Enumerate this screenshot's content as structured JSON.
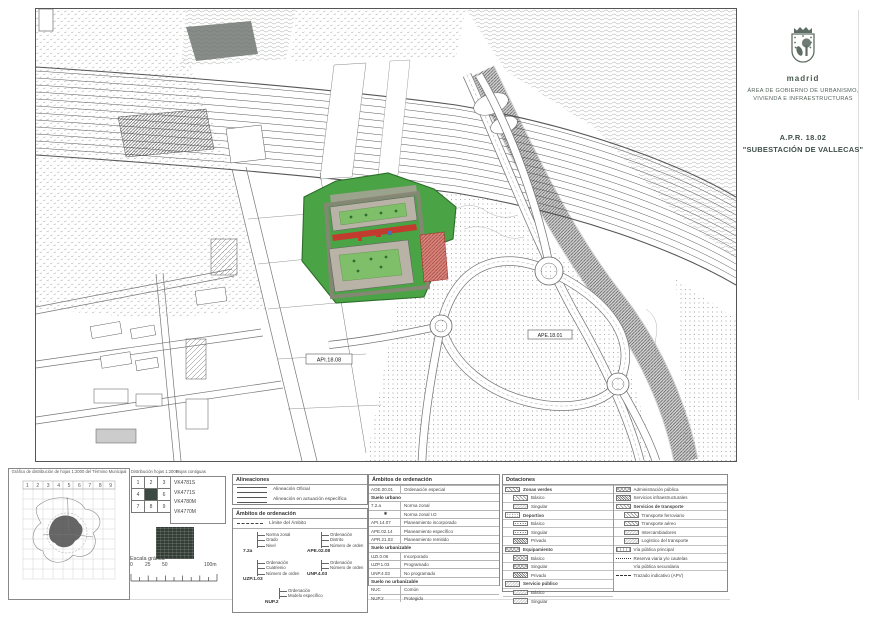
{
  "title_block": {
    "city": "madrid",
    "dept_line1": "ÁREA DE GOBIERNO DE URBANISMO,",
    "dept_line2": "VIVIENDA E INFRAESTRUCTURAS",
    "plan_code": "A.P.R. 18.02",
    "plan_name": "\"SUBESTACIÓN DE VALLECAS\""
  },
  "map": {
    "label_api": "API.18.08",
    "label_ape": "APE.18.01"
  },
  "locator": {
    "heading": "Gráfico de distribución de hojas 1:2000 del Término Municipal",
    "column_numbers": "1 2 3 4 5 6 7 8 9",
    "dist_title": "Distribución hojas 1:2000",
    "adjacent_title": "Hojas contiguas",
    "grid": [
      "1",
      "2",
      "3",
      "4",
      "",
      "6",
      "7",
      "8",
      "9"
    ],
    "sheet_codes": [
      "VK4781S",
      "VK4771S",
      "VK4780M",
      "VK4770M"
    ],
    "scale_label": "Escala gráfica",
    "scale_ticks": [
      "0",
      "25",
      "50",
      "100m"
    ]
  },
  "legend": {
    "alineaciones": {
      "title": "Alineaciones",
      "item1": "Alineación Oficial",
      "item2": "Alineación en actuación específica"
    },
    "ambitos_diag": {
      "title": "Ámbitos de ordenación",
      "limit_label": "Límite del Ámbito",
      "d1": {
        "code": "7.2a",
        "c1": "Norma zonal",
        "c2": "Grado",
        "c3": "Nivel"
      },
      "d2": {
        "code": "APE.02.08",
        "c1": "Ordenación",
        "c2": "Distrito",
        "c3": "Número de orden"
      },
      "d3": {
        "code": "UZP.1.03",
        "c1": "Ordenación",
        "c2": "Cuatrienio",
        "c3": "Número de orden"
      },
      "d4": {
        "code": "UNP.4.03",
        "c1": "Ordenación",
        "c2": "Número de orden"
      },
      "d5": {
        "code": "NUP.2",
        "c1": "Ordenación",
        "c2": "Modelo específico"
      }
    },
    "ambitos_tab": {
      "title": "Ámbitos de ordenación",
      "r1c": "AOE.00.01",
      "r1l": "Ordenación especial",
      "s1": "Suelo urbano",
      "r2c": "7.2.a",
      "r2l": "Norma zonal",
      "r3c": "✱",
      "r3l": "Norma zonal I.D",
      "r4c": "API.14.07",
      "r4l": "Planeamiento incorporado",
      "r5c": "APE.02.14",
      "r5l": "Planeamiento específico",
      "r6c": "APR.21.03",
      "r6l": "Planeamiento remitido",
      "s2": "Suelo urbanizable",
      "r7c": "UZI.0.06",
      "r7l": "Incorporado",
      "r8c": "UZP.1.03",
      "r8l": "Programado",
      "r9c": "UNP.4.03",
      "r9l": "No programado",
      "s3": "Suelo no urbanizable",
      "r10c": "NUC",
      "r10l": "Común",
      "r11c": "NUP.2",
      "r11l": "Protegido"
    },
    "dotaciones": {
      "title": "Dotaciones",
      "g1": "Zonas verdes",
      "g1i1": "Básico",
      "g1i2": "Singular",
      "g2": "Deportivo",
      "g2i1": "Básico",
      "g2i2": "Singular",
      "g2i3": "Privado",
      "g3": "Equipamiento",
      "g3i1": "Básico",
      "g3i2": "Singular",
      "g3i3": "Privado",
      "g4": "Servicio público",
      "g4i1": "Básico",
      "g4i2": "Singular",
      "r1": "Administración pública",
      "r2": "Servicios infraestructurales",
      "g5": "Servicios de transporte",
      "g5i1": "Transporte ferroviario",
      "g5i2": "Transporte aéreo",
      "g5i3": "Intercambiadores",
      "g5i4": "Logístico del transporte",
      "r3": "Vía pública principal",
      "r4": "Reserva viaria y/o cautelas",
      "r5": "Vía pública secundaria",
      "r6": "Trazado indicativo (APV)"
    }
  }
}
